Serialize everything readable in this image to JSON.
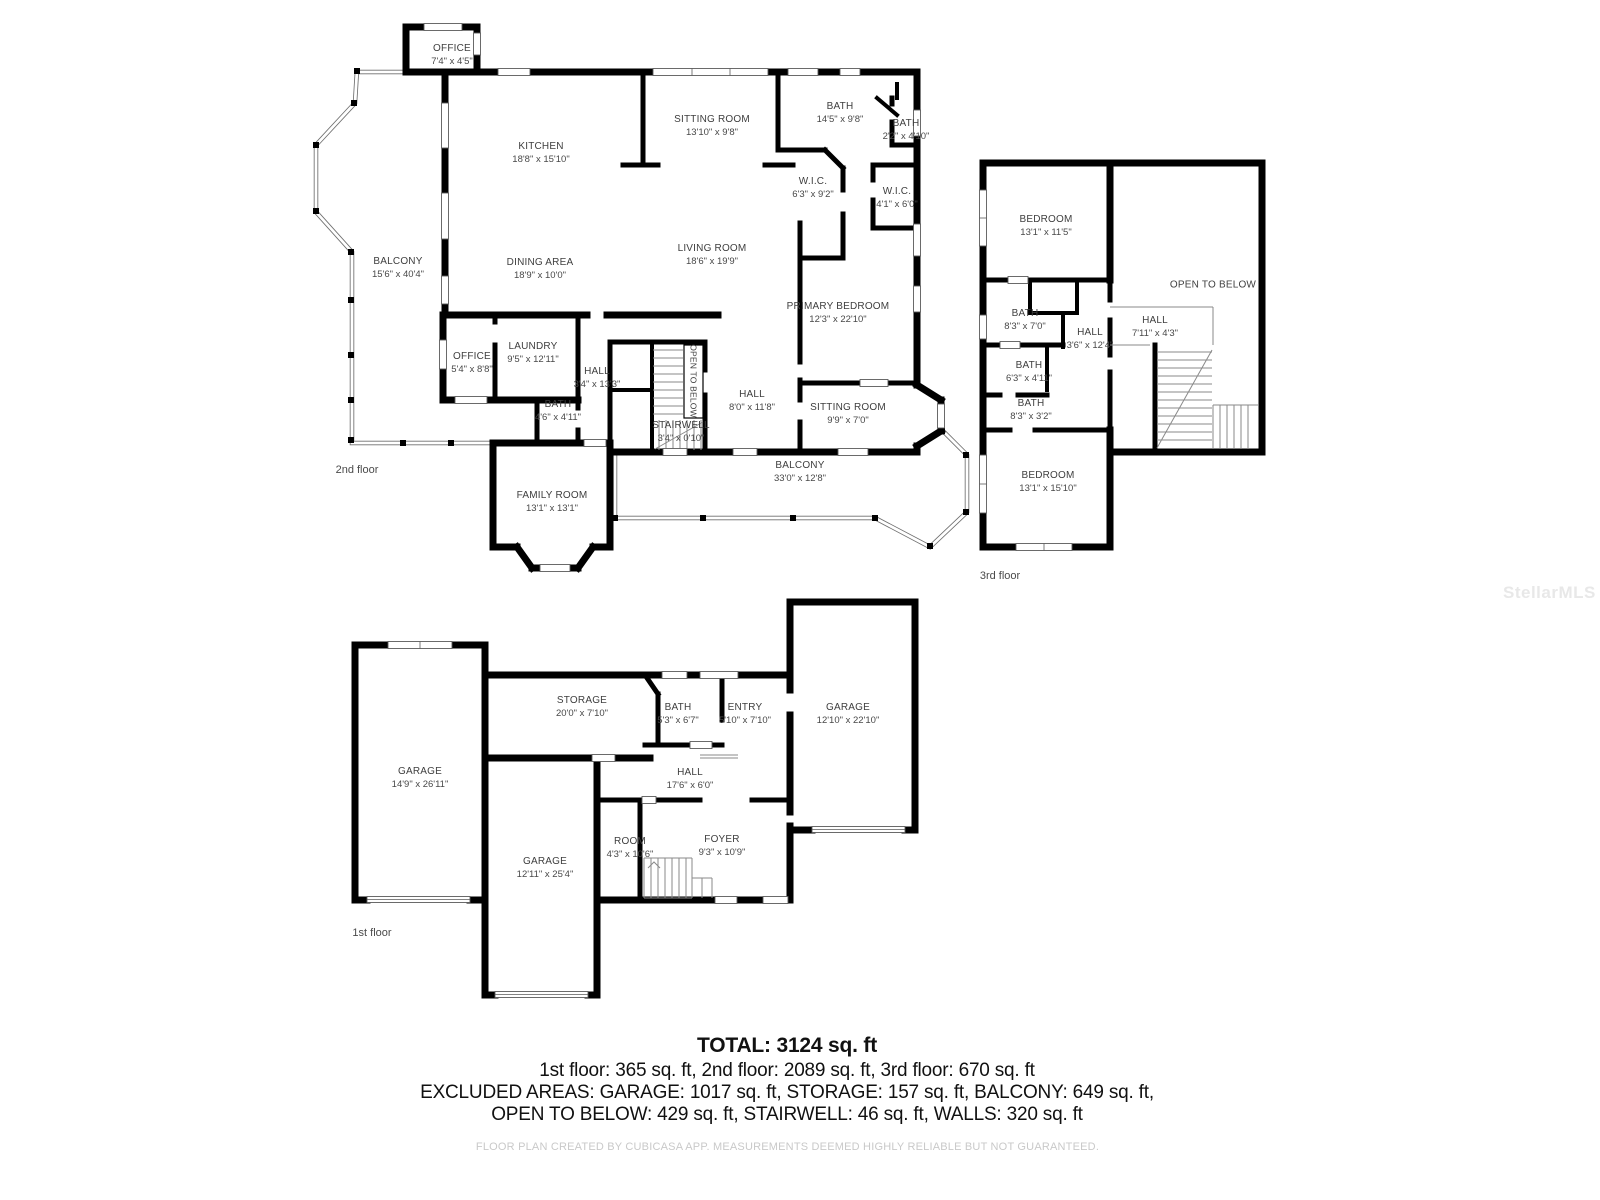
{
  "watermark": "StellarMLS",
  "colors": {
    "wall": "#000000",
    "room_text": "#3e3e3e",
    "summary_text": "#111111",
    "muted_text": "#c9c9c9",
    "background": "#ffffff"
  },
  "floors": [
    {
      "id": "2nd-floor",
      "tag": {
        "text": "2nd floor",
        "x": 357,
        "y": 470
      },
      "rooms": [
        {
          "name": "OFFICE",
          "dims": "7'4\" x 4'5\"",
          "x": 452,
          "y": 55
        },
        {
          "name": "KITCHEN",
          "dims": "18'8\" x 15'10\"",
          "x": 541,
          "y": 153
        },
        {
          "name": "SITTING ROOM",
          "dims": "13'10\" x 9'8\"",
          "x": 712,
          "y": 126
        },
        {
          "name": "BATH",
          "dims": "14'5\" x 9'8\"",
          "x": 840,
          "y": 113
        },
        {
          "name": "BATH",
          "dims": "2'2\" x 4'10\"",
          "x": 906,
          "y": 130
        },
        {
          "name": "W.I.C.",
          "dims": "6'3\" x 9'2\"",
          "x": 813,
          "y": 188
        },
        {
          "name": "W.I.C.",
          "dims": "4'1\" x 6'0\"",
          "x": 897,
          "y": 198
        },
        {
          "name": "LIVING ROOM",
          "dims": "18'6\" x 19'9\"",
          "x": 712,
          "y": 255
        },
        {
          "name": "DINING AREA",
          "dims": "18'9\" x 10'0\"",
          "x": 540,
          "y": 269
        },
        {
          "name": "PRIMARY BEDROOM",
          "dims": "12'3\" x 22'10\"",
          "x": 838,
          "y": 313
        },
        {
          "name": "BALCONY",
          "dims": "15'6\" x 40'4\"",
          "x": 398,
          "y": 268
        },
        {
          "name": "OFFICE",
          "dims": "5'4\" x 8'8\"",
          "x": 472,
          "y": 363
        },
        {
          "name": "LAUNDRY",
          "dims": "9'5\" x 12'11\"",
          "x": 533,
          "y": 353
        },
        {
          "name": "HALL",
          "dims": "3'4\" x 13'3\"",
          "x": 597,
          "y": 378
        },
        {
          "name": "BATH",
          "dims": "4'6\" x 4'11\"",
          "x": 558,
          "y": 411
        },
        {
          "name": "OPEN TO BELOW",
          "dims": "",
          "x": 693,
          "y": 381,
          "rot": 90,
          "fs": 8.5
        },
        {
          "name": "STAIRWELL",
          "dims": "3'4\" x 0'10\"",
          "x": 681,
          "y": 432
        },
        {
          "name": "HALL",
          "dims": "8'0\" x 11'8\"",
          "x": 752,
          "y": 401
        },
        {
          "name": "SITTING ROOM",
          "dims": "9'9\" x 7'0\"",
          "x": 848,
          "y": 414
        },
        {
          "name": "BALCONY",
          "dims": "33'0\" x 12'8\"",
          "x": 800,
          "y": 472
        },
        {
          "name": "FAMILY ROOM",
          "dims": "13'1\" x 13'1\"",
          "x": 552,
          "y": 502
        }
      ]
    },
    {
      "id": "3rd-floor",
      "tag": {
        "text": "3rd floor",
        "x": 1000,
        "y": 576
      },
      "rooms": [
        {
          "name": "BEDROOM",
          "dims": "13'1\" x 11'5\"",
          "x": 1046,
          "y": 226
        },
        {
          "name": "OPEN TO BELOW",
          "dims": "",
          "x": 1213,
          "y": 285
        },
        {
          "name": "BATH",
          "dims": "8'3\" x 7'0\"",
          "x": 1025,
          "y": 320
        },
        {
          "name": "HALL",
          "dims": "3'6\" x 12'4\"",
          "x": 1090,
          "y": 339
        },
        {
          "name": "HALL",
          "dims": "7'11\" x 4'3\"",
          "x": 1155,
          "y": 327
        },
        {
          "name": "BATH",
          "dims": "6'3\" x 4'11\"",
          "x": 1029,
          "y": 372
        },
        {
          "name": "BATH",
          "dims": "8'3\" x 3'2\"",
          "x": 1031,
          "y": 410
        },
        {
          "name": "BEDROOM",
          "dims": "13'1\" x 15'10\"",
          "x": 1048,
          "y": 482
        }
      ]
    },
    {
      "id": "1st-floor",
      "tag": {
        "text": "1st floor",
        "x": 372,
        "y": 933
      },
      "rooms": [
        {
          "name": "GARAGE",
          "dims": "14'9\" x 26'11\"",
          "x": 420,
          "y": 778
        },
        {
          "name": "STORAGE",
          "dims": "20'0\" x 7'10\"",
          "x": 582,
          "y": 707
        },
        {
          "name": "BATH",
          "dims": "5'3\" x 6'7\"",
          "x": 678,
          "y": 714
        },
        {
          "name": "ENTRY",
          "dims": "5'10\" x 7'10\"",
          "x": 745,
          "y": 714
        },
        {
          "name": "GARAGE",
          "dims": "12'10\" x 22'10\"",
          "x": 848,
          "y": 714
        },
        {
          "name": "HALL",
          "dims": "17'6\" x 6'0\"",
          "x": 690,
          "y": 779
        },
        {
          "name": "ROOM",
          "dims": "4'3\" x 10'6\"",
          "x": 630,
          "y": 848
        },
        {
          "name": "FOYER",
          "dims": "9'3\" x 10'9\"",
          "x": 722,
          "y": 846
        },
        {
          "name": "GARAGE",
          "dims": "12'11\" x 25'4\"",
          "x": 545,
          "y": 868
        }
      ]
    }
  ],
  "summary": {
    "total": "TOTAL: 3124 sq. ft",
    "line1": "1st floor: 365 sq. ft, 2nd floor: 2089 sq. ft, 3rd floor: 670 sq. ft",
    "line2": "EXCLUDED AREAS: GARAGE: 1017 sq. ft, STORAGE: 157 sq. ft, BALCONY: 649 sq. ft,",
    "line3": "OPEN TO BELOW: 429 sq. ft, STAIRWELL: 46 sq. ft, WALLS: 320 sq. ft",
    "footer": "FLOOR PLAN CREATED BY CUBICASA APP. MEASUREMENTS DEEMED HIGHLY RELIABLE BUT NOT GUARANTEED."
  }
}
